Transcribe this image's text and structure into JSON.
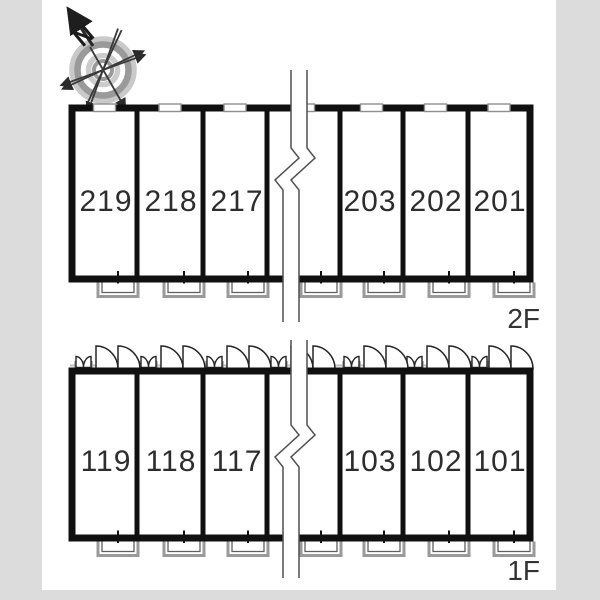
{
  "page": {
    "type": "apartment-floor-plan"
  },
  "compass": {
    "north_label": "N"
  },
  "floors": [
    {
      "label": "2F",
      "units": [
        {
          "number": "219"
        },
        {
          "number": "218"
        },
        {
          "number": "217"
        },
        {
          "number": "203"
        },
        {
          "number": "202"
        },
        {
          "number": "201"
        }
      ]
    },
    {
      "label": "1F",
      "units": [
        {
          "number": "119"
        },
        {
          "number": "118"
        },
        {
          "number": "117"
        },
        {
          "number": "103"
        },
        {
          "number": "102"
        },
        {
          "number": "101"
        }
      ]
    }
  ],
  "colors": {
    "wall": "#101010",
    "unit_text": "#2d2d2d",
    "margin_gray": "#dcdcdc",
    "detail_gray": "#9a9a9a"
  }
}
